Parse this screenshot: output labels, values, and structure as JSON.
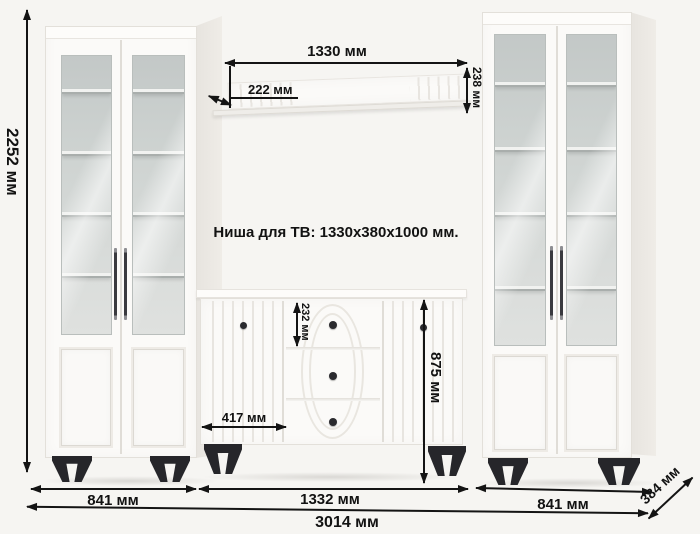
{
  "diagram": {
    "niche_label": "Ниша для ТВ: 1330x380x1000 мм.",
    "dimensions": {
      "total_height": "2252 мм",
      "shelf_width": "1330 мм",
      "shelf_depth": "222 мм",
      "shelf_height": "238 мм",
      "top_drawer_height": "232 мм",
      "stand_door_width": "417 мм",
      "stand_height": "875 мм",
      "left_cabinet_width": "841 мм",
      "center_section_width": "1332 мм",
      "right_cabinet_width": "841 мм",
      "total_width": "3014 мм",
      "depth": "384 мм"
    },
    "colors": {
      "background": "#f6f5f2",
      "furniture": "#fbfaf8",
      "glass": "#ced3d1",
      "legs": "#26262a",
      "annotation": "#141414"
    }
  }
}
